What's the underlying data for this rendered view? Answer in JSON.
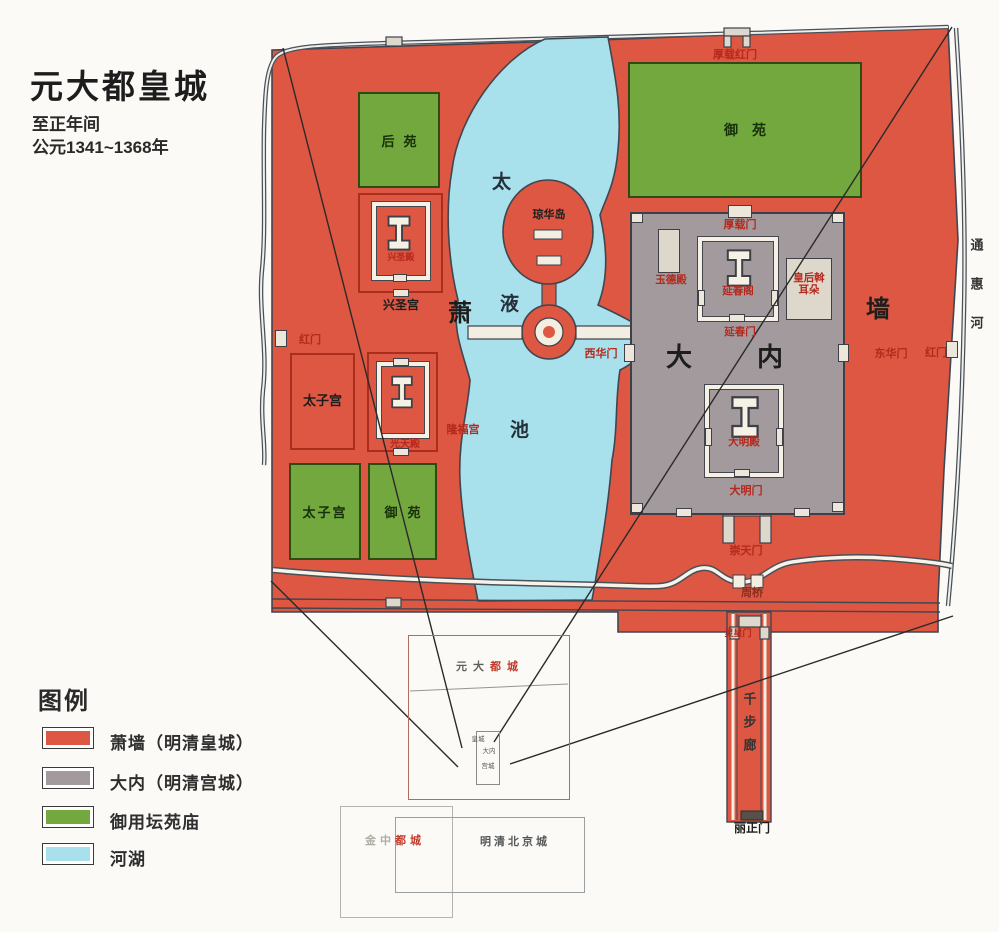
{
  "title": {
    "main": "元大都皇城",
    "era": "至正年间",
    "years": "公元1341~1368年"
  },
  "colors": {
    "xiaoqiang_red": "#dd5742",
    "danei_gray": "#a29a9d",
    "garden_green": "#73a83e",
    "water_blue": "#a8e0ec"
  },
  "legend": {
    "heading": "图例",
    "items": [
      {
        "label": "萧墙（明清皇城）",
        "color": "#dd5742"
      },
      {
        "label": "大内（明清宫城）",
        "color": "#a29a9d"
      },
      {
        "label": "御用坛苑庙",
        "color": "#73a83e"
      },
      {
        "label": "河湖",
        "color": "#a8e0ec"
      }
    ]
  },
  "map": {
    "walls": {
      "xiao": "萧",
      "qiang": "墙"
    },
    "lake": {
      "tai": "太",
      "ye": "液",
      "chi": "池",
      "island": "琼华岛"
    },
    "gates": {
      "houzai_hong": "厚载红门",
      "hong_left": "红门",
      "hong_right": "红门",
      "xihua": "西华门",
      "donghua": "东华门",
      "houzai": "厚载门",
      "yanchun": "延春门",
      "daming": "大明门",
      "chongtian": "崇天门",
      "lingxing": "灵星门",
      "lizheng": "丽正门"
    },
    "palaces": {
      "houyuan": "后苑",
      "yuyuan_n": "御苑",
      "xingshengdian": "兴圣殿",
      "xingshenggong": "兴圣宫",
      "taizigong_n": "太子宫",
      "guangtiandian": "光天殿",
      "longfugong": "隆福宫",
      "taizigong_s": "太子宫",
      "yuyuan_s": "御苑",
      "yude": "玉德殿",
      "yanchunge": "延春阁",
      "empress": "皇后斡耳朵",
      "da": "大",
      "nei": "内",
      "damingdian": "大明殿"
    },
    "river": {
      "tonghui": "通惠河",
      "zhouqiao": "周桥",
      "qianbulang": "千步廊"
    }
  },
  "inset": {
    "yuandadu_pre": "元大",
    "yuandadu_suf": "都城",
    "huangcheng": "皇城",
    "danei": "大内",
    "gongcheng": "宫城",
    "jinzhongdu_pre": "金中",
    "jinzhongdu_suf": "都城",
    "mingqing": "明清北京城"
  }
}
